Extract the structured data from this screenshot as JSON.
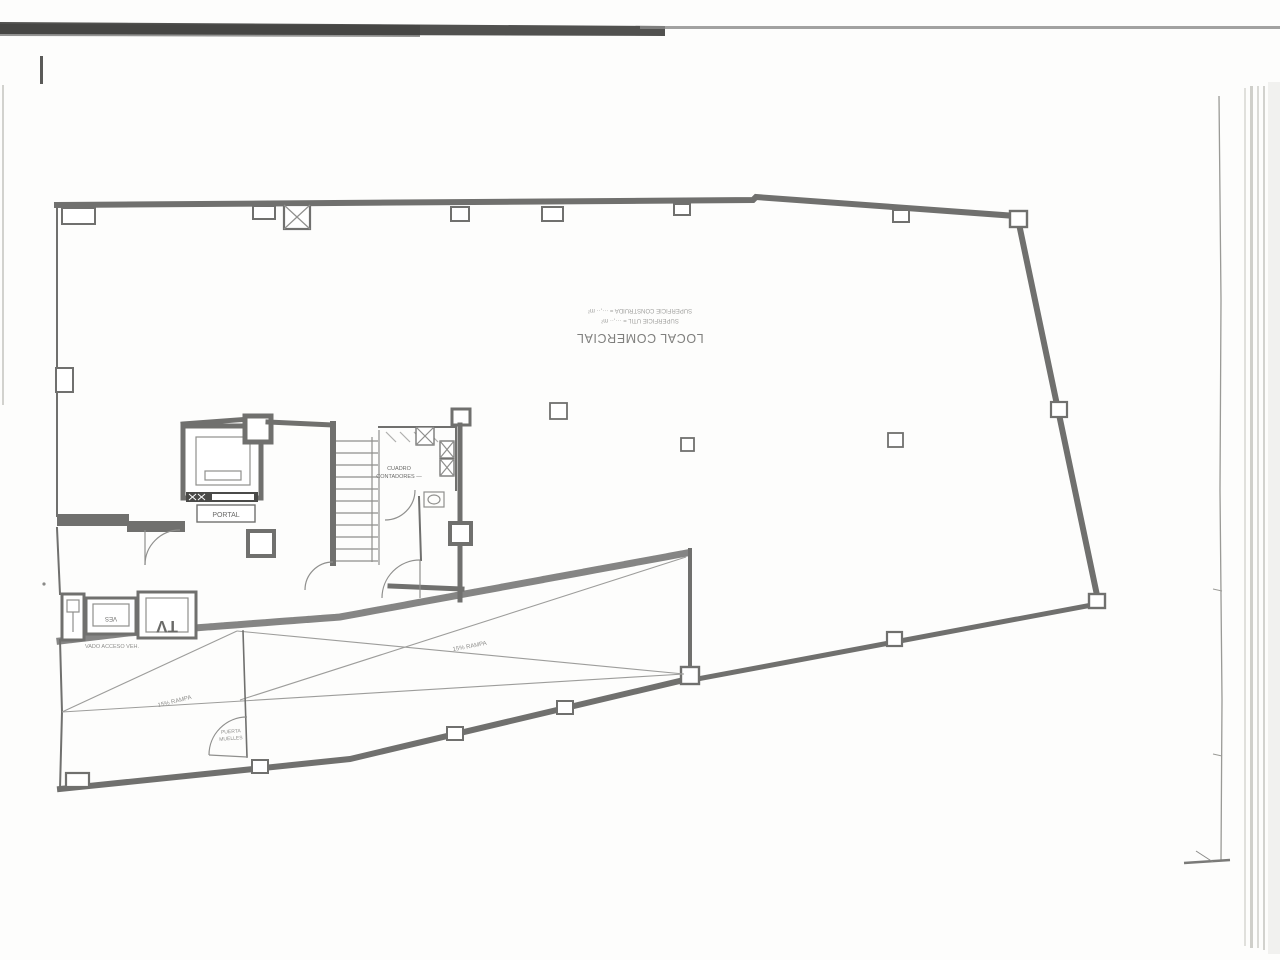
{
  "plan": {
    "labels": {
      "local": "LOCAL COMERCIAL",
      "sup_util": "SUPERFICIE UTIL = ···,·· m²",
      "sup_construida": "SUPERFICIE CONSTRUIDA = ···,·· m²",
      "portal": "PORTAL",
      "contadores_1": "CUADRO",
      "contadores_2": "CONTADORES —",
      "ves": "VES",
      "tv": "TV",
      "vado": "VADO ACCESO VEH.",
      "ramp_left": "15% RAMPA",
      "ramp_right": "15% RAMPA",
      "puerta_1": "PUERTA",
      "puerta_2": "MUELLES"
    },
    "colors": {
      "paper": "#fdfdfc",
      "ink": "#70706e",
      "scan_bar": "#3e3e3c",
      "faint": "#9d9d9b"
    }
  }
}
